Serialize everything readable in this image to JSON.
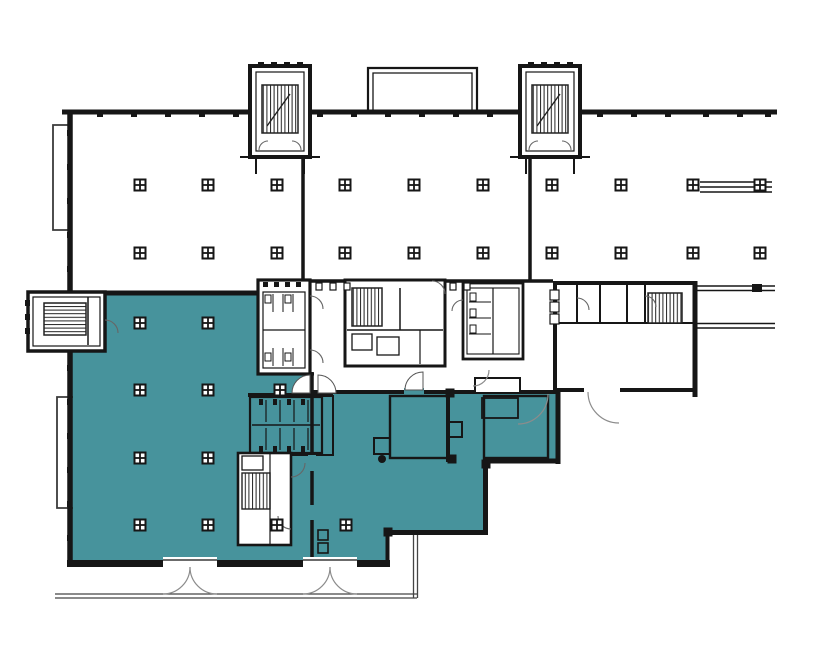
{
  "app": {
    "name": "Architectural floor plan",
    "view": "building level plan with highlighted suite"
  },
  "colors": {
    "background": "#ffffff",
    "highlight": "#47939C",
    "wall": "#161616",
    "thin_line": "#3a3a3a",
    "door_arc": "#8c8c8c",
    "sidewalk_line": "#444444"
  },
  "floor_plan": {
    "highlighted_space": {
      "label": "highlighted-availability-area",
      "fill": "#47939C"
    },
    "highlight_regions": [
      {
        "name": "highlighted-suite",
        "points": "105,293 260,293 260,372 312,372 312,390 560,390 560,463 483,463 483,533 388,533 388,567 72,567 72,350 105,350"
      }
    ],
    "columns": {
      "square": [
        [
          140,
          185
        ],
        [
          208,
          185
        ],
        [
          277,
          185
        ],
        [
          345,
          185
        ],
        [
          414,
          185
        ],
        [
          483,
          185
        ],
        [
          552,
          185
        ],
        [
          621,
          185
        ],
        [
          693,
          185
        ],
        [
          760,
          185
        ],
        [
          140,
          253
        ],
        [
          208,
          253
        ],
        [
          277,
          253
        ],
        [
          345,
          253
        ],
        [
          414,
          253
        ],
        [
          483,
          253
        ],
        [
          552,
          253
        ],
        [
          621,
          253
        ],
        [
          693,
          253
        ],
        [
          760,
          253
        ],
        [
          140,
          323
        ],
        [
          208,
          323
        ],
        [
          140,
          390
        ],
        [
          208,
          390
        ],
        [
          280,
          390
        ],
        [
          140,
          458
        ],
        [
          208,
          458
        ],
        [
          140,
          525
        ],
        [
          208,
          525
        ],
        [
          277,
          525
        ],
        [
          346,
          525
        ]
      ],
      "round": [
        [
          382,
          459
        ],
        [
          451,
          459
        ]
      ],
      "solid": [
        [
          450,
          393
        ],
        [
          452,
          459
        ],
        [
          486,
          464
        ],
        [
          388,
          532
        ]
      ]
    }
  }
}
